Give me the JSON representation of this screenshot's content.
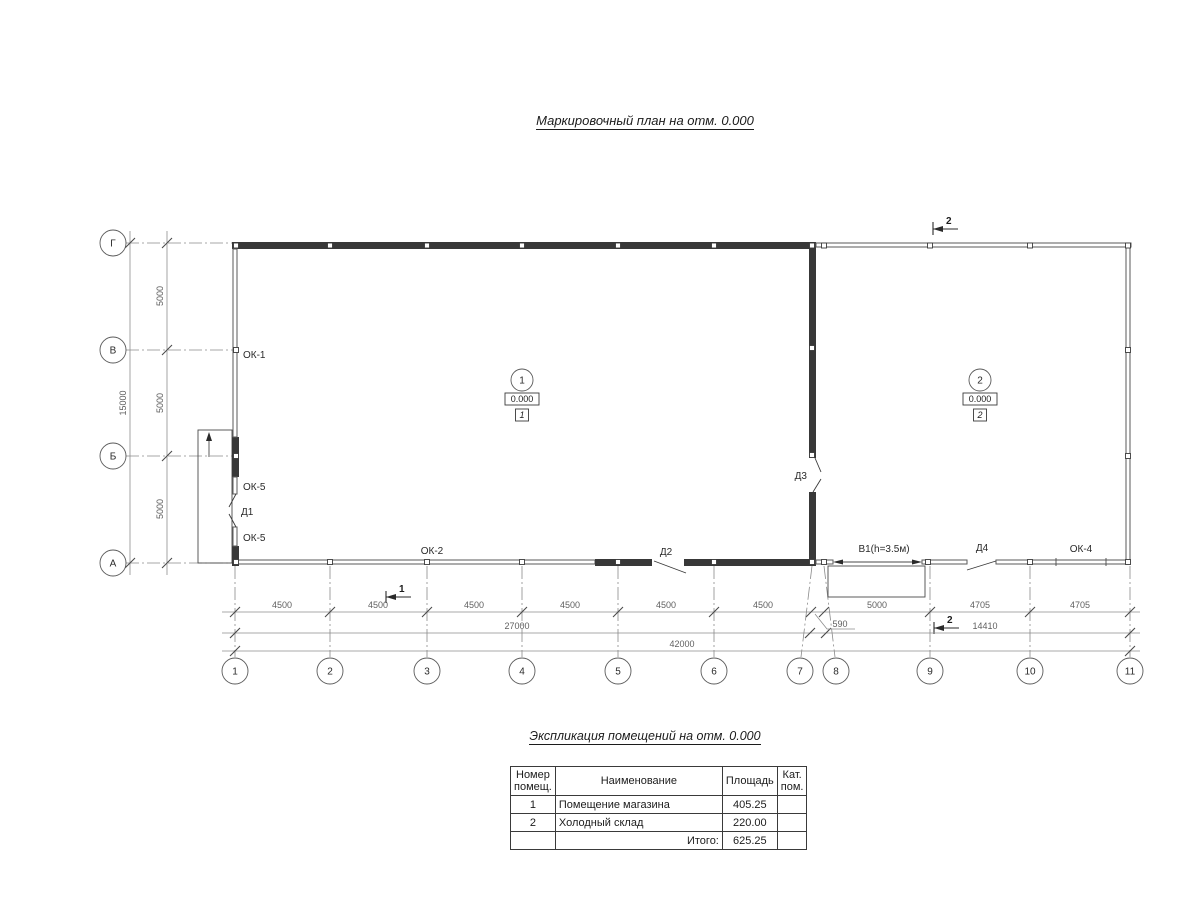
{
  "drawing_title": "Маркировочный план  на отм. 0.000",
  "plan": {
    "row_axes": [
      "Г",
      "В",
      "Б",
      "А"
    ],
    "col_axes": [
      "1",
      "2",
      "3",
      "4",
      "5",
      "6",
      "7",
      "8",
      "9",
      "10",
      "11"
    ],
    "v_dims": [
      "5000",
      "5000",
      "5000"
    ],
    "v_dim_total": "15000",
    "h_dims_row1": [
      "4500",
      "4500",
      "4500",
      "4500",
      "4500",
      "4500",
      "5000",
      "4705",
      "4705"
    ],
    "h_dim_offset": "590",
    "h_dims_row2": [
      "27000",
      "14410"
    ],
    "h_dim_total": "42000",
    "openings": {
      "ok1": "ОК-1",
      "ok5_upper": "ОК-5",
      "d1": "Д1",
      "ok5_lower": "ОК-5",
      "ok2": "ОК-2",
      "d2": "Д2",
      "d3": "Д3",
      "v1": "В1(h=3.5м)",
      "d4": "Д4",
      "ok4": "ОК-4"
    },
    "rooms": [
      {
        "number": "1",
        "elevation": "0.000",
        "tag": "1"
      },
      {
        "number": "2",
        "elevation": "0.000",
        "tag": "2"
      }
    ],
    "sections": {
      "top": "2",
      "bottom_left": "1",
      "bottom_right": "2"
    }
  },
  "table": {
    "title": "Экспликация помещений на отм. 0.000",
    "headers": {
      "number_l1": "Номер",
      "number_l2": "помещ.",
      "name": "Наименование",
      "area": "Площадь",
      "category_l1": "Кат.",
      "category_l2": "пом."
    },
    "rows": [
      {
        "number": "1",
        "name": "Помещение магазина",
        "area": "405.25",
        "category": ""
      },
      {
        "number": "2",
        "name": "Холодный склад",
        "area": "220.00",
        "category": ""
      }
    ],
    "total_label": "Итого:",
    "total_area": "625.25"
  }
}
